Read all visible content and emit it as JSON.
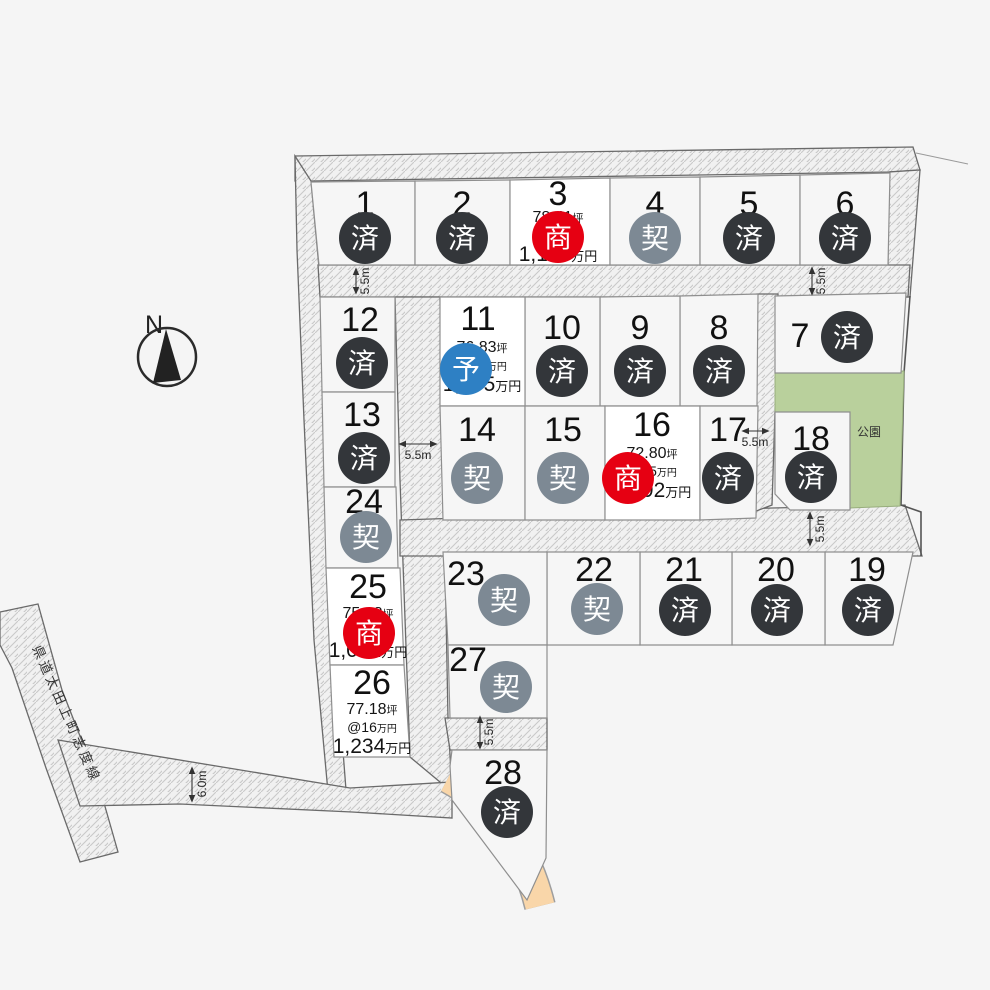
{
  "map": {
    "compass_label": "N",
    "park_label": "公園",
    "road_label": "県道太田上町志度線",
    "colors": {
      "background": "#f5f5f5",
      "lot_fill": "#f6f6f6",
      "lot_available_fill": "#ffffff",
      "park": "#b9d09c",
      "waterway": "#f9d6a9",
      "sold_badge": "#33363a",
      "contracted_badge": "#7d8994",
      "negotiating_badge": "#e60012",
      "reserved_badge": "#2e80c4"
    },
    "dims": {
      "top_left": "5.5m",
      "top_right": "5.5m",
      "mid_left": "5.5m",
      "mid_right": "5.5m",
      "below_lot18": "5.5m",
      "between_27_28": "5.5m",
      "bottom_road": "6.0m"
    },
    "statuses": {
      "sold": {
        "glyph": "済",
        "color": "#33363a"
      },
      "contracted": {
        "glyph": "契",
        "color": "#7d8994"
      },
      "negotiating": {
        "glyph": "商",
        "color": "#e60012"
      },
      "reserved": {
        "glyph": "予",
        "color": "#2e80c4"
      }
    },
    "lots": [
      {
        "id": 1,
        "status": "sold"
      },
      {
        "id": 2,
        "status": "sold"
      },
      {
        "id": 3,
        "status": "negotiating",
        "area": "78.41",
        "area_unit": "坪",
        "unit_price": "@15",
        "unit_price_unit": "万円",
        "price": "1,176",
        "price_unit": "万円"
      },
      {
        "id": 4,
        "status": "contracted"
      },
      {
        "id": 5,
        "status": "sold"
      },
      {
        "id": 6,
        "status": "sold"
      },
      {
        "id": 7,
        "status": "sold"
      },
      {
        "id": 8,
        "status": "sold"
      },
      {
        "id": 9,
        "status": "sold"
      },
      {
        "id": 10,
        "status": "sold"
      },
      {
        "id": 11,
        "status": "reserved",
        "area": "76.83",
        "area_unit": "坪",
        "unit_price": "@14",
        "unit_price_unit": "万円",
        "price": "1,075",
        "price_unit": "万円"
      },
      {
        "id": 12,
        "status": "sold"
      },
      {
        "id": 13,
        "status": "sold"
      },
      {
        "id": 14,
        "status": "contracted"
      },
      {
        "id": 15,
        "status": "contracted"
      },
      {
        "id": 16,
        "status": "negotiating",
        "area": "72.80",
        "area_unit": "坪",
        "unit_price": "@15",
        "unit_price_unit": "万円",
        "price": "1,092",
        "price_unit": "万円"
      },
      {
        "id": 17,
        "status": "sold"
      },
      {
        "id": 18,
        "status": "sold"
      },
      {
        "id": 19,
        "status": "sold"
      },
      {
        "id": 20,
        "status": "sold"
      },
      {
        "id": 21,
        "status": "sold"
      },
      {
        "id": 22,
        "status": "contracted"
      },
      {
        "id": 23,
        "status": "contracted"
      },
      {
        "id": 24,
        "status": "contracted"
      },
      {
        "id": 25,
        "status": "negotiating",
        "area": "75.18",
        "area_unit": "坪",
        "unit_price": "@14",
        "unit_price_unit": "万円",
        "price": "1,052",
        "price_unit": "万円"
      },
      {
        "id": 26,
        "status": null,
        "area": "77.18",
        "area_unit": "坪",
        "unit_price": "@16",
        "unit_price_unit": "万円",
        "price": "1,234",
        "price_unit": "万円"
      },
      {
        "id": 27,
        "status": "contracted"
      },
      {
        "id": 28,
        "status": "sold"
      }
    ]
  }
}
